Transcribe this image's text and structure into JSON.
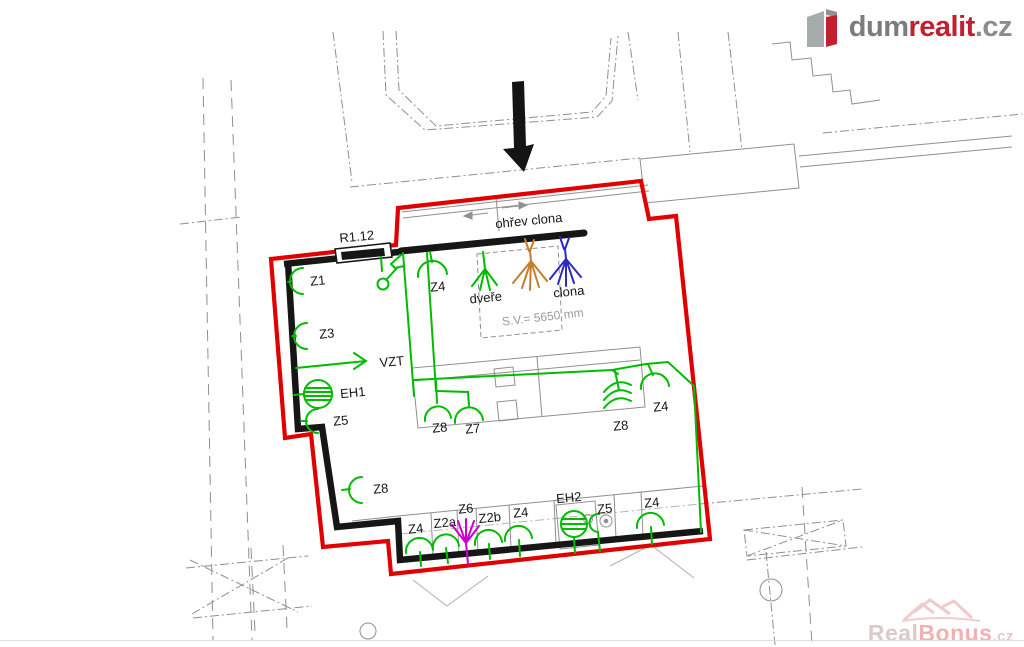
{
  "branding": {
    "logo": {
      "prefix": "dum",
      "highlight": "realit",
      "tld": ".cz",
      "brand_red": "#c2202f",
      "brand_gray": "#7c7c7c"
    },
    "watermark": {
      "prefix": "Real",
      "highlight": "Bonus",
      "tld": ".cz",
      "color": "#eec6c6"
    }
  },
  "plan": {
    "board_label": "R1.12",
    "ceiling_height": "S.V.= 5650 mm",
    "annotations": {
      "heater_curtain": "ohřev clona",
      "door": "dveře",
      "curtain": "clona",
      "ventilation": "VZT"
    },
    "devices": [
      {
        "id": "Z1",
        "label": "Z1"
      },
      {
        "id": "Z3",
        "label": "Z3"
      },
      {
        "id": "Z4-door",
        "label": "Z4"
      },
      {
        "id": "EH1",
        "label": "EH1"
      },
      {
        "id": "Z5-left",
        "label": "Z5"
      },
      {
        "id": "Z8-left",
        "label": "Z8"
      },
      {
        "id": "Z8-mid",
        "label": "Z8"
      },
      {
        "id": "Z7",
        "label": "Z7"
      },
      {
        "id": "Z8-right",
        "label": "Z8"
      },
      {
        "id": "Z4-right",
        "label": "Z4"
      },
      {
        "id": "Z4-bottom-1",
        "label": "Z4"
      },
      {
        "id": "Z2a",
        "label": "Z2a"
      },
      {
        "id": "Z6",
        "label": "Z6"
      },
      {
        "id": "Z2b",
        "label": "Z2b"
      },
      {
        "id": "Z4-bottom-2",
        "label": "Z4"
      },
      {
        "id": "EH2",
        "label": "EH2"
      },
      {
        "id": "Z5-bottom",
        "label": "Z5"
      },
      {
        "id": "Z4-bottom-3",
        "label": "Z4"
      }
    ],
    "colors": {
      "boundary": "#e10000",
      "walls": "#161616",
      "wiring": "#00bb00",
      "curtain_heater_symbol": "#c77d2e",
      "curtain_symbol": "#2b2bc0",
      "fan_symbol": "#cc00cc"
    }
  }
}
